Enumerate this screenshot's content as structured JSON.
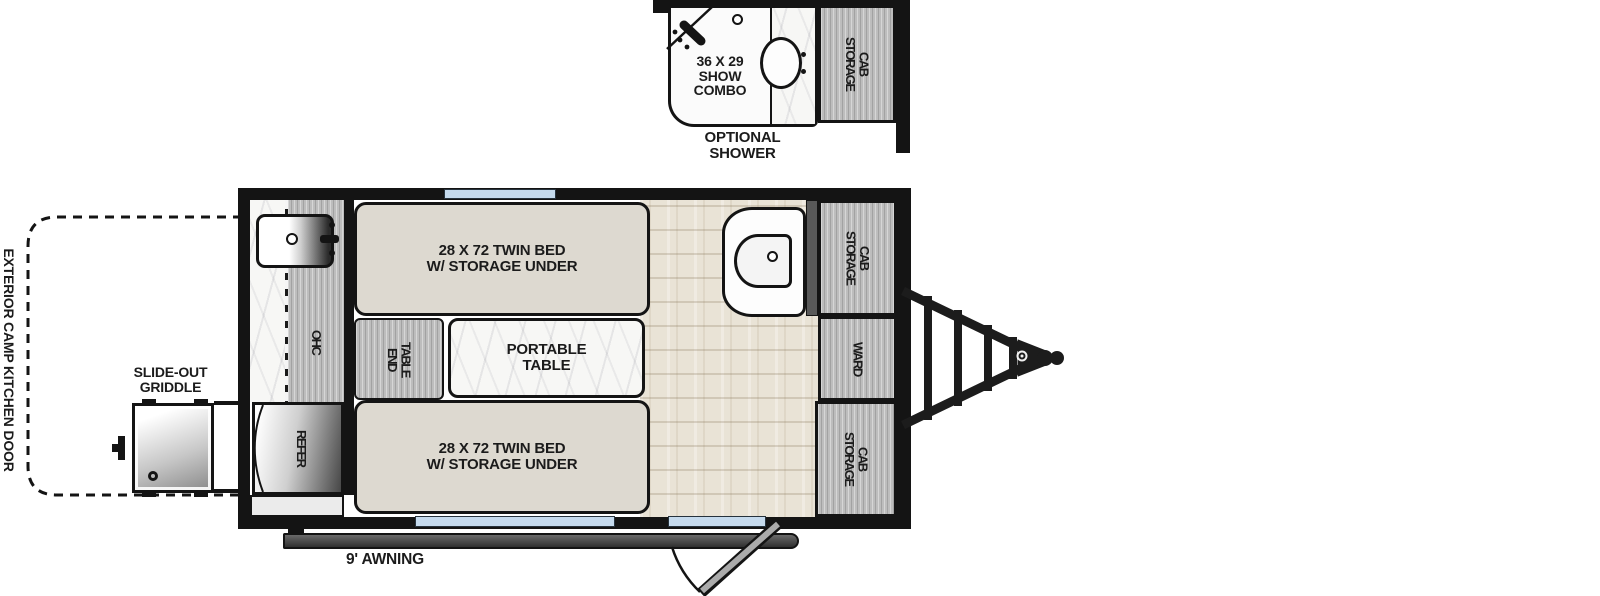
{
  "floorplan": {
    "optional_shower": {
      "size_label": "36 X 29\nSHOW\nCOMBO",
      "storage_cab_label": "STORAGE\nCAB",
      "caption": "OPTIONAL\nSHOWER"
    },
    "main": {
      "twin_bed_top_label": "28 X 72 TWIN BED\nW/ STORAGE UNDER",
      "twin_bed_bottom_label": "28 X 72 TWIN BED\nW/ STORAGE UNDER",
      "portable_table_label": "PORTABLE\nTABLE",
      "end_table_label": "END\nTABLE",
      "ohc_label": "OHC",
      "refer_label": "REFER",
      "storage_cab_top_label": "STORAGE\nCAB",
      "ward_label": "WARD",
      "storage_cab_bottom_label": "STORAGE\nCAB"
    },
    "exterior": {
      "camp_kitchen_door_label": "EXTERIOR CAMP KITCHEN DOOR",
      "slide_out_griddle_label": "SLIDE-OUT\nGRIDDLE",
      "awning_label": "9' AWNING"
    },
    "colors": {
      "wall_black": "#141414",
      "window_blue": "#c5daed",
      "cabinet_gray": "#bdbdbd",
      "bed_beige": "#ddd9d0",
      "floor_wood": "#e9e3d6",
      "awning_gray": "#474747"
    }
  }
}
